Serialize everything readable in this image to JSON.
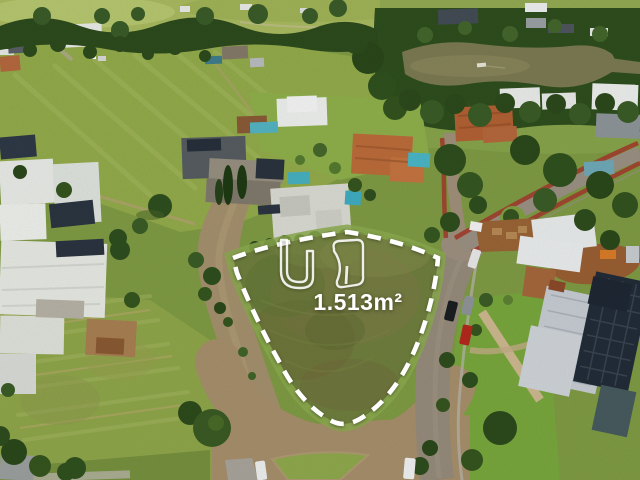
{
  "overlay": {
    "area_label": "1.513m²",
    "watermark_icon": "realtor-logo-outline-icon",
    "boundary_style": "white-dashed-outline",
    "boundary_color": "#ffffff"
  },
  "scene": {
    "description": "Aerial drone photo of a vacant corner lot marked with a white dashed boundary inside a luxury gated community, surrounded by streets, lawns, modern houses with solar panels, pools, tree canopy and a lake.",
    "colors": {
      "lot_grass": "#6f7f3e",
      "mowed_field": "#93ab4b",
      "tree_canopy": "#2e4e1e",
      "gravel_road": "#a4906d",
      "asphalt_road": "#968b7b",
      "lake_water": "#7b7a52",
      "white_roof": "#eef0ee",
      "terracotta_roof": "#b56a3c",
      "solar_panel": "#232c38",
      "pool_water": "#4ab6c6",
      "bike_path_red": "#a33f2e"
    }
  }
}
